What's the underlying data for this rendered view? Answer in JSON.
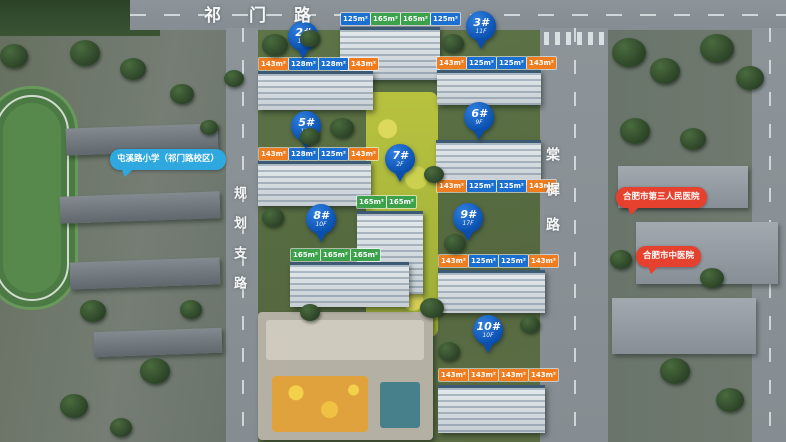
{
  "map": {
    "roads": {
      "top": "祁门路",
      "left": "规划支路",
      "right": "棠樨路"
    },
    "pins": [
      {
        "no": "2#",
        "floors": "17F"
      },
      {
        "no": "3#",
        "floors": "11F"
      },
      {
        "no": "5#",
        "floors": "15F"
      },
      {
        "no": "6#",
        "floors": "9F"
      },
      {
        "no": "7#",
        "floors": "2F"
      },
      {
        "no": "8#",
        "floors": "10F"
      },
      {
        "no": "9#",
        "floors": "17F"
      },
      {
        "no": "10#",
        "floors": "10F"
      }
    ],
    "buildings": [
      {
        "id": "1",
        "units": [
          "125m²",
          "165m²",
          "165m²",
          "125m²"
        ],
        "types": [
          "blue",
          "green",
          "green",
          "blue"
        ]
      },
      {
        "id": "2",
        "units": [
          "143m²",
          "128m²",
          "128m²",
          "143m²"
        ],
        "types": [
          "orange",
          "blue",
          "blue",
          "orange"
        ]
      },
      {
        "id": "3",
        "units": [
          "143m²",
          "125m²",
          "125m²",
          "143m²"
        ],
        "types": [
          "orange",
          "blue",
          "blue",
          "orange"
        ]
      },
      {
        "id": "5",
        "units": [
          "143m²",
          "128m²",
          "125m²",
          "143m²"
        ],
        "types": [
          "orange",
          "blue",
          "blue",
          "orange"
        ]
      },
      {
        "id": "6",
        "units": [
          "143m²",
          "125m²",
          "125m²",
          "143m²"
        ],
        "types": [
          "orange",
          "blue",
          "blue",
          "orange"
        ]
      },
      {
        "id": "7",
        "units": [
          "165m²",
          "165m²"
        ],
        "types": [
          "green",
          "green"
        ]
      },
      {
        "id": "8",
        "units": [
          "165m²",
          "165m²",
          "165m²"
        ],
        "types": [
          "green",
          "green",
          "green"
        ]
      },
      {
        "id": "9",
        "units": [
          "143m²",
          "125m²",
          "125m²",
          "143m²"
        ],
        "types": [
          "orange",
          "blue",
          "blue",
          "orange"
        ]
      },
      {
        "id": "10",
        "units": [
          "143m²",
          "143m²",
          "143m²",
          "143m²"
        ],
        "types": [
          "orange",
          "orange",
          "orange",
          "orange"
        ]
      }
    ],
    "pois": [
      {
        "label": "屯溪路小学（祁门路校区）",
        "color": "#2fa8e0"
      },
      {
        "label": "合肥市第三人民医院",
        "color": "#e6402e"
      },
      {
        "label": "合肥市中医院",
        "color": "#e6402e"
      }
    ],
    "colors": {
      "pin_blue": "#0b4fae",
      "chip_blue": "#1b6fd0",
      "chip_green": "#3ca14b",
      "chip_orange": "#ef7d20",
      "poi_blue": "#2fa8e0",
      "poi_red": "#e6402e"
    }
  }
}
